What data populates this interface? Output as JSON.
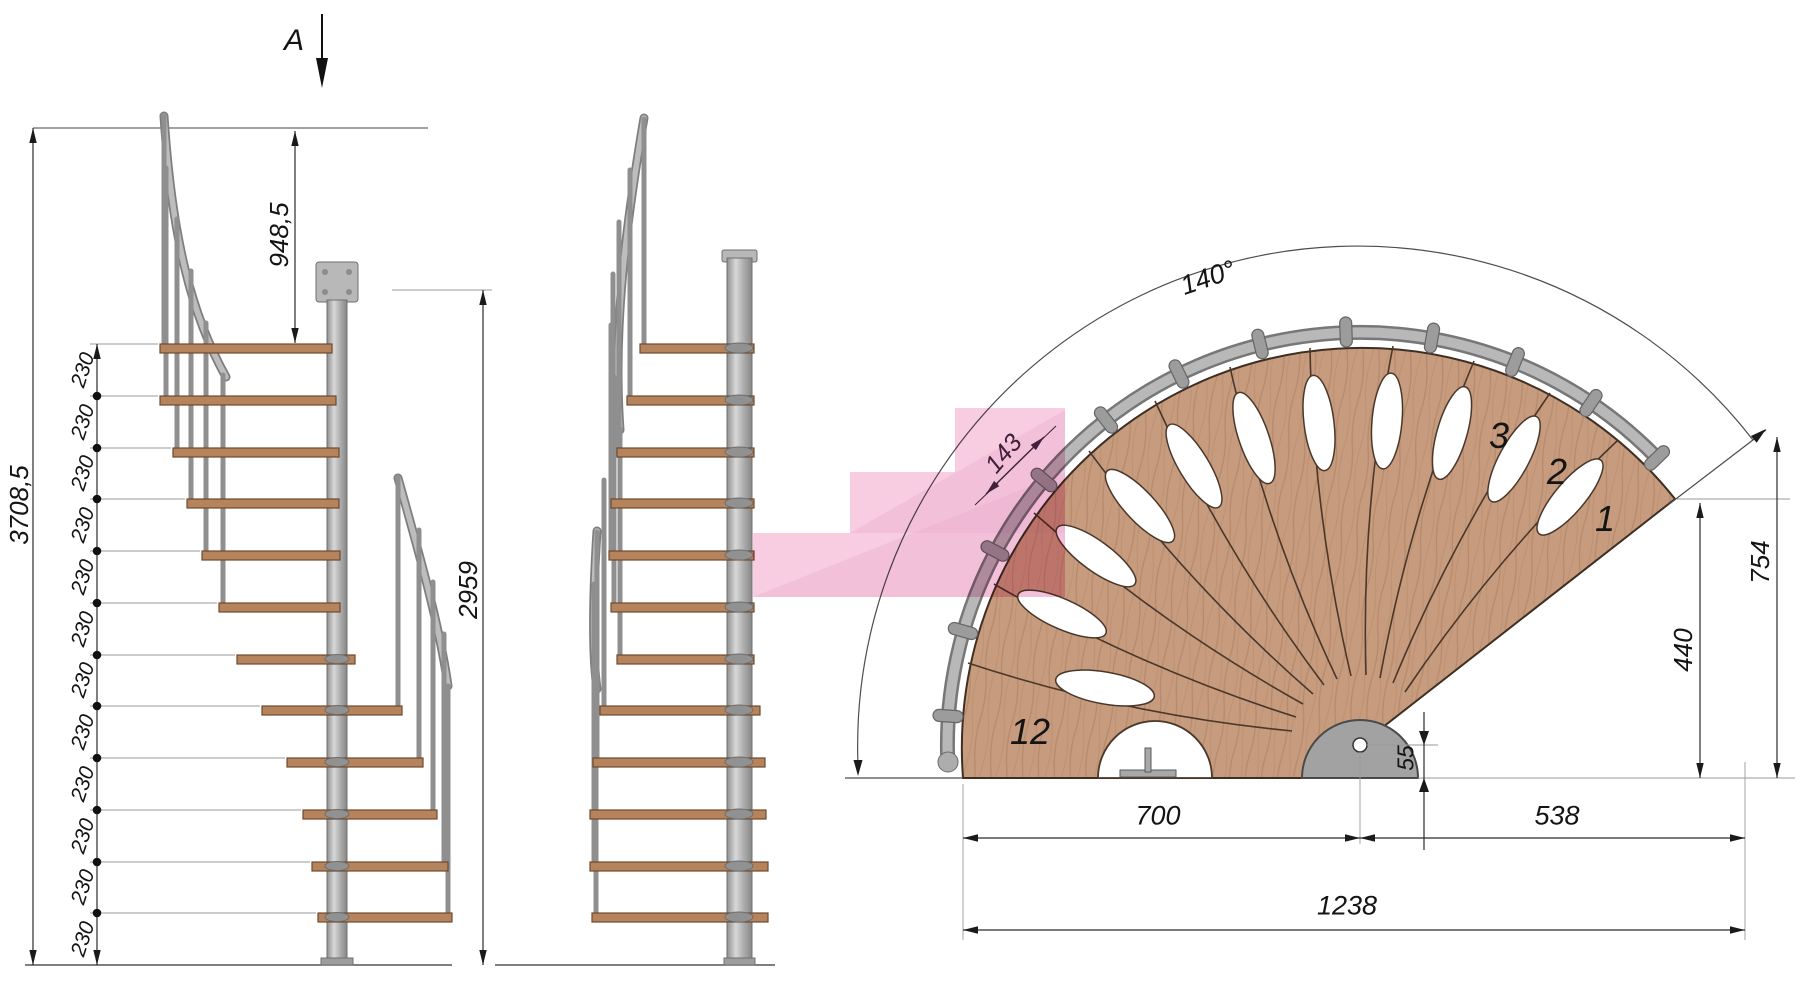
{
  "drawing": {
    "section_marker": {
      "label": "A"
    },
    "side_view": {
      "total_height": "3708,5",
      "top_riser_height": "948,5",
      "riser_heights": [
        "230",
        "230",
        "230",
        "230",
        "230",
        "230",
        "230",
        "230",
        "230",
        "230",
        "230",
        "230"
      ]
    },
    "front_view": {
      "rail_height": "2959"
    },
    "plan_view": {
      "rotation_angle": "140°",
      "walkline_tread_width": "143",
      "outer_radius": "754",
      "step_corner_height": "440",
      "pole_offset": "55",
      "width_left_of_pole": "700",
      "width_right_of_pole": "538",
      "total_width": "1238",
      "step_numbers": {
        "first": "1",
        "second": "2",
        "third": "3",
        "last": "12"
      }
    },
    "colors": {
      "wood": "#c79c7e",
      "metal": "#a8a8a8",
      "highlight_pink": "#f7c4dd",
      "line": "#1a1a1a"
    }
  }
}
